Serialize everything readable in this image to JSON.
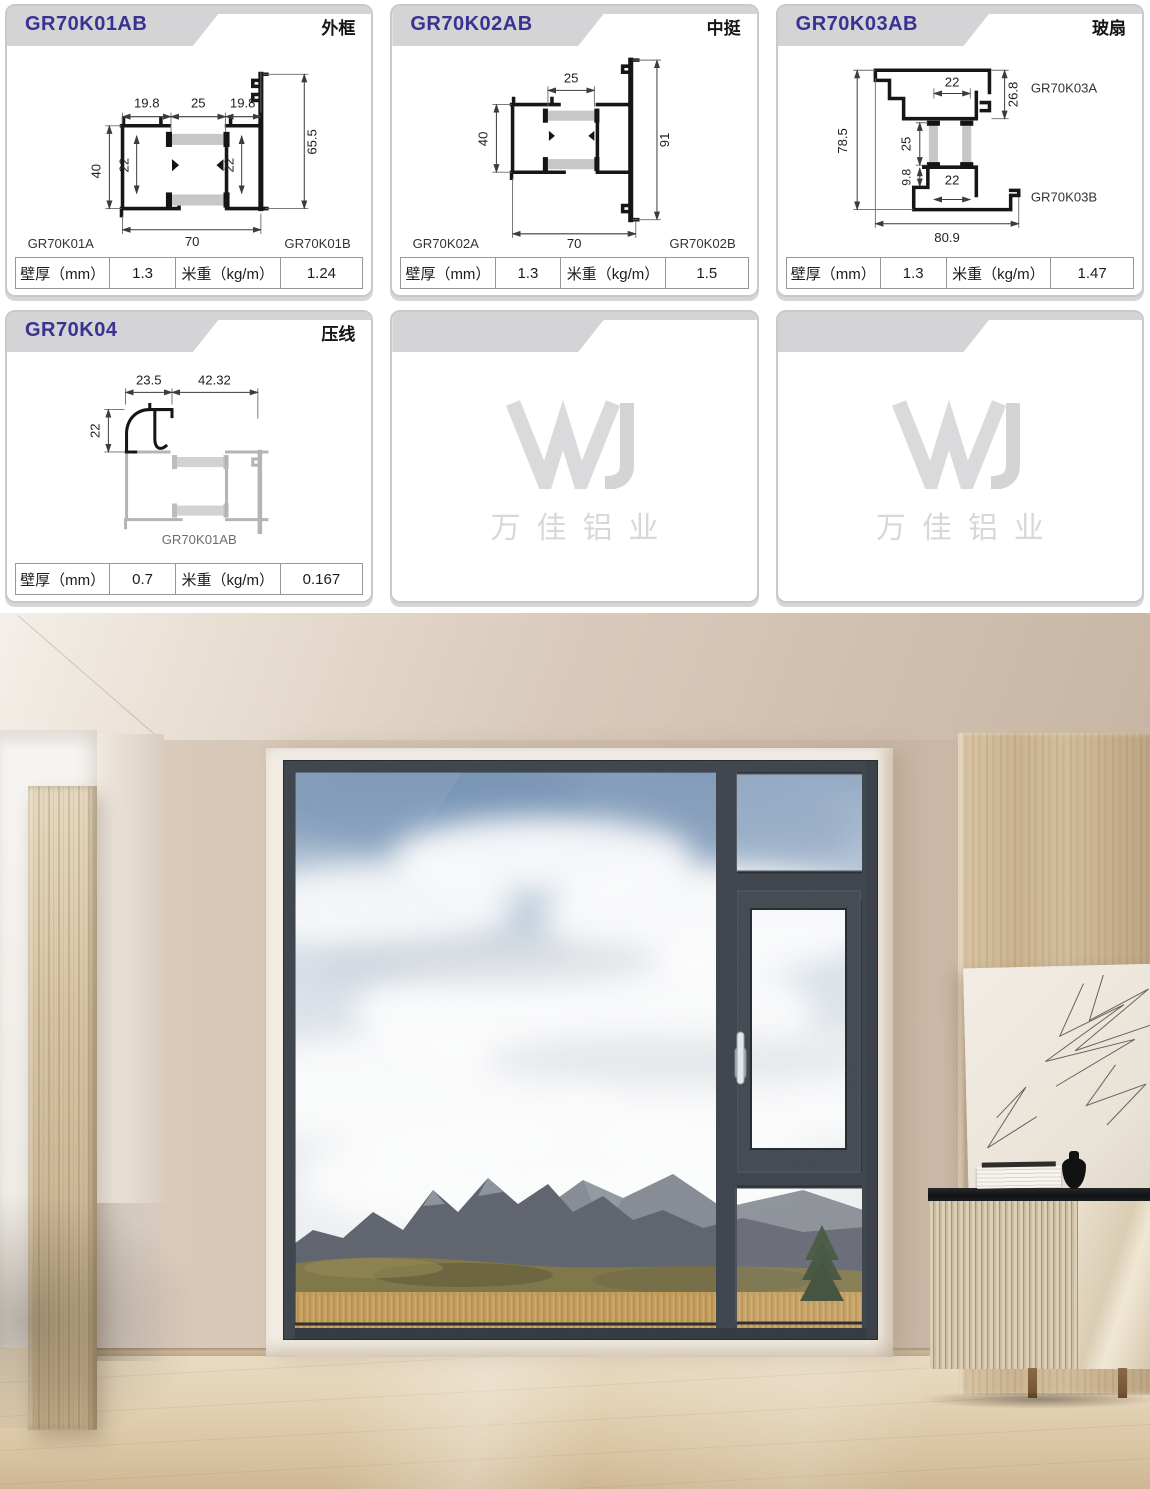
{
  "colors": {
    "title_purple": "#3a3193",
    "band_gray": "#d4d4d6",
    "card_border": "#c9c9cb",
    "table_border": "#97979a",
    "insulation_gray": "#c7c7c9",
    "window_frame_charcoal": "#3f454c",
    "wall_beige": "#d2c1b0",
    "wood_panel": "#cdb795",
    "floor_wood": "#e2d1b4"
  },
  "cards": [
    {
      "code": "GR70K01AB",
      "kind": "外框",
      "label_a": "GR70K01A",
      "label_b": "GR70K01B",
      "dims": {
        "top_left": "19.8",
        "top_mid": "25",
        "top_right": "19.8",
        "left": "40",
        "inner_left": "22",
        "inner_right": "22",
        "right": "65.5",
        "bottom": "70"
      },
      "spec": {
        "c1": "壁厚（mm）",
        "v1": "1.3",
        "c2": "米重（kg/m）",
        "v2": "1.24"
      }
    },
    {
      "code": "GR70K02AB",
      "kind": "中挺",
      "label_a": "GR70K02A",
      "label_b": "GR70K02B",
      "dims": {
        "top": "25",
        "left": "40",
        "right": "91",
        "bottom": "70"
      },
      "spec": {
        "c1": "壁厚（mm）",
        "v1": "1.3",
        "c2": "米重（kg/m）",
        "v2": "1.5"
      }
    },
    {
      "code": "GR70K03AB",
      "kind": "玻扇",
      "label_a": "GR70K03A",
      "label_b": "GR70K03B",
      "dims": {
        "top": "22",
        "top_right": "26.8",
        "left": "78.5",
        "mid": "25",
        "small": "9.8",
        "lower": "22",
        "bottom": "80.9"
      },
      "spec": {
        "c1": "壁厚（mm）",
        "v1": "1.3",
        "c2": "米重（kg/m）",
        "v2": "1.47"
      }
    },
    {
      "code": "GR70K04",
      "kind": "压线",
      "ref_label": "GR70K01AB",
      "dims": {
        "top_left": "23.5",
        "top_right": "42.32",
        "left": "22"
      },
      "spec": {
        "c1": "壁厚（mm）",
        "v1": "0.7",
        "c2": "米重（kg/m）",
        "v2": "0.167"
      }
    }
  ],
  "watermark": {
    "logo": "WJ",
    "company": "万佳铝业"
  }
}
